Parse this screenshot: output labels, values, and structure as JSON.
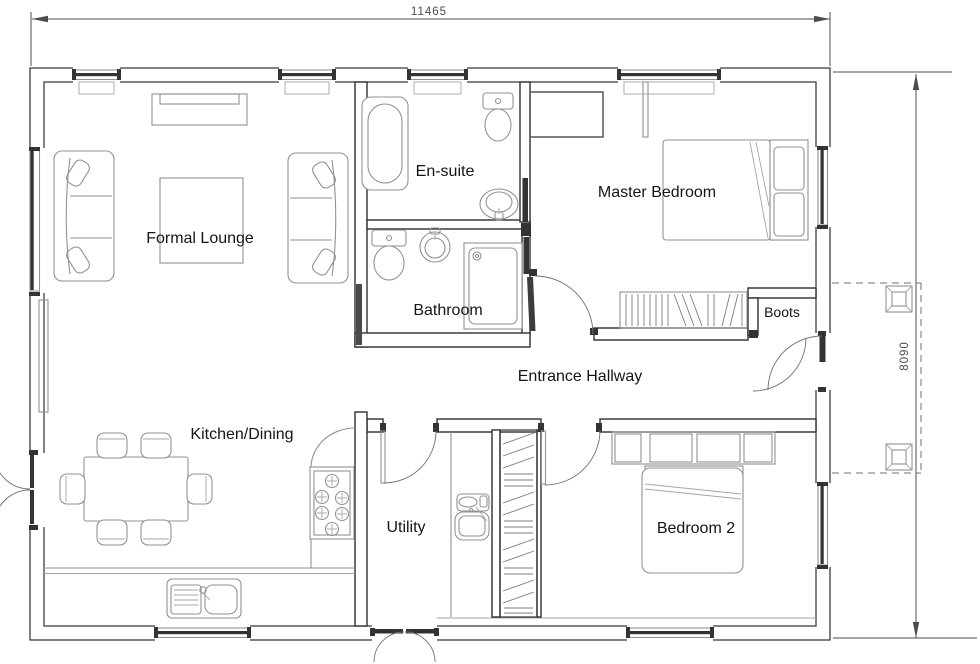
{
  "plan": {
    "title": "Bungalow floor plan",
    "dimensions": {
      "width_label": "11465",
      "depth_label": "8090"
    },
    "rooms": {
      "formal_lounge": {
        "label": "Formal Lounge"
      },
      "en_suite": {
        "label": "En-suite"
      },
      "master_bedroom": {
        "label": "Master Bedroom"
      },
      "bathroom": {
        "label": "Bathroom"
      },
      "entrance_hallway": {
        "label": "Entrance Hallway"
      },
      "kitchen_dining": {
        "label": "Kitchen/Dining"
      },
      "utility": {
        "label": "Utility"
      },
      "bedroom_2": {
        "label": "Bedroom 2"
      },
      "boots": {
        "label": "Boots"
      }
    },
    "fixtures": [
      "bathtub",
      "toilet",
      "wash-basin",
      "shower",
      "pedestal-sink",
      "double-bed",
      "headboard-shelves",
      "wardrobe",
      "radiator",
      "sofa",
      "coffee-table",
      "tv-unit",
      "dining-table",
      "dining-chair",
      "hob",
      "kitchen-sink",
      "utility-sink",
      "worktop",
      "airing-cupboard",
      "porch-post",
      "window",
      "door"
    ],
    "colors": {
      "wall": "#2f2f2f",
      "fixture": "#929292",
      "glazing": "#333333",
      "dimension": "#4d4d4d",
      "background": "#ffffff"
    }
  }
}
